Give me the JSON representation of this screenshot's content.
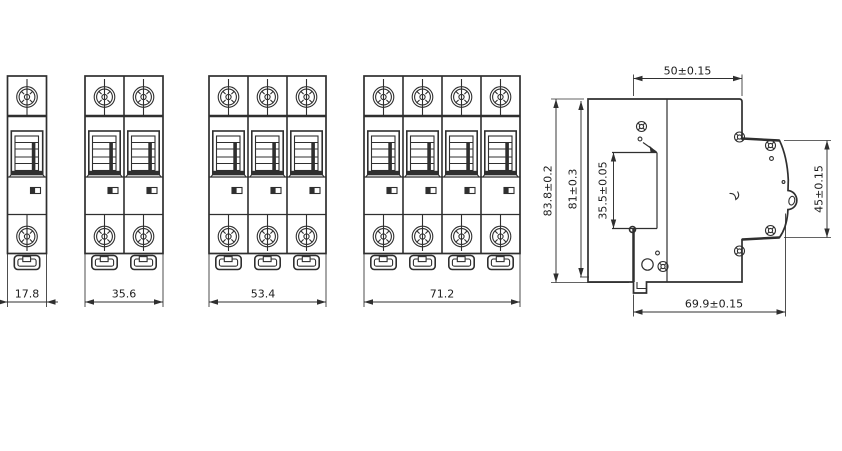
{
  "front_views": [
    {
      "name": "front-view-1-pole",
      "width": "17.8"
    },
    {
      "name": "front-view-2-pole",
      "width": "35.6"
    },
    {
      "name": "front-view-3-pole",
      "width": "53.4"
    },
    {
      "name": "front-view-4-pole",
      "width": "71.2"
    }
  ],
  "side_view": {
    "top_depth": "50±0.15",
    "overall_height": "83.8±0.2",
    "body_height": "81±0.3",
    "din_slot_height": "35.5±0.05",
    "front_face_height": "45±0.15",
    "overall_depth": "69.9±0.15"
  },
  "colors": {
    "line": "#2f2f2f",
    "background": "#ffffff"
  }
}
